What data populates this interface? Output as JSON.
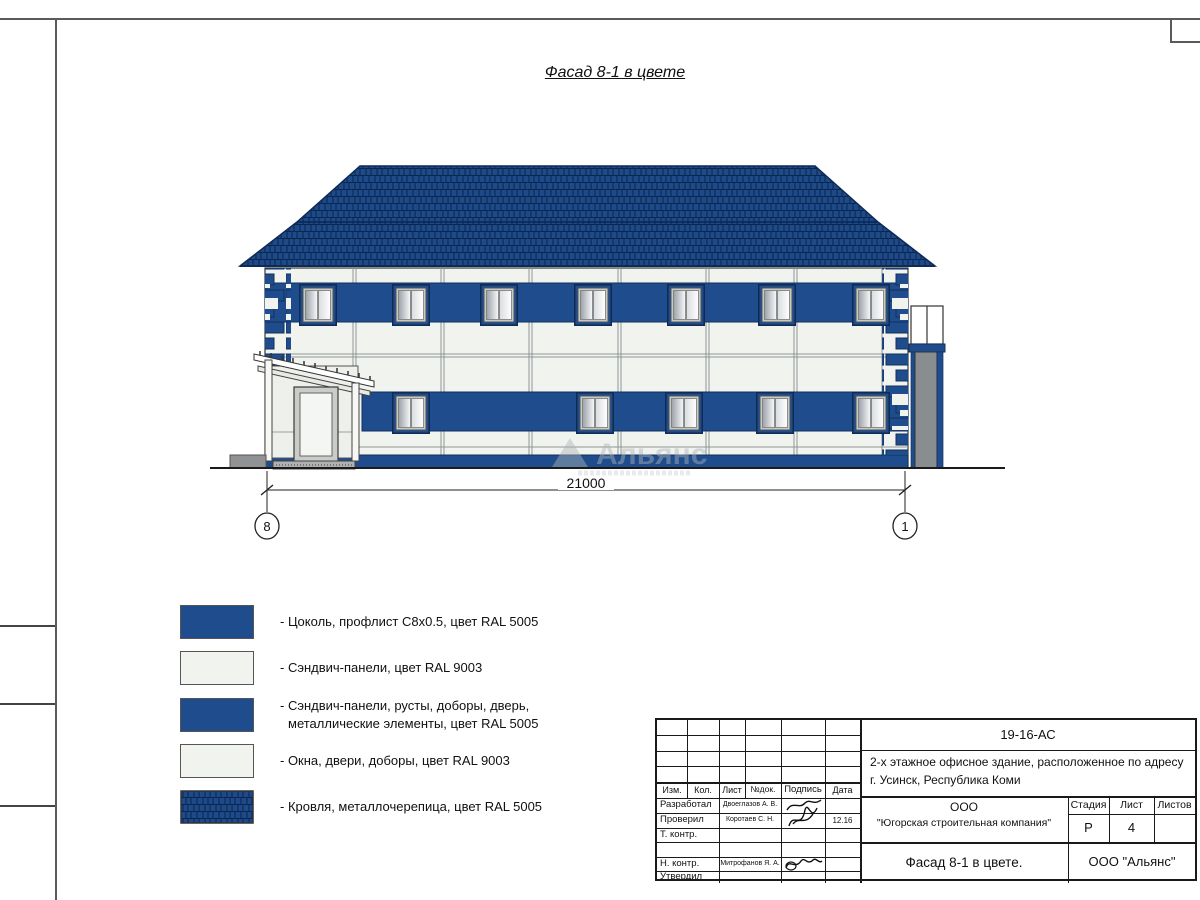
{
  "drawing_title": "Фасад 8-1 в цвете",
  "facade": {
    "dimension": "21000",
    "axis_left": "8",
    "axis_right": "1",
    "watermark": "Альянс"
  },
  "legend": {
    "items": [
      {
        "swatch": "solid-blue",
        "lines": [
          "- Цоколь, профлист С8х0.5, цвет RAL 5005"
        ]
      },
      {
        "swatch": "solid-white",
        "lines": [
          "- Сэндвич-панели, цвет RAL 9003"
        ]
      },
      {
        "swatch": "solid-blue",
        "lines": [
          "- Сэндвич-панели, русты, доборы, дверь,",
          "металлические элементы, цвет RAL 5005"
        ]
      },
      {
        "swatch": "solid-white",
        "lines": [
          "- Окна, двери, доборы, цвет RAL 9003"
        ]
      },
      {
        "swatch": "roof-tiles",
        "lines": [
          "- Кровля, металлочерепица, цвет RAL 5005"
        ]
      }
    ]
  },
  "title_block": {
    "doc_number": "19-16-АС",
    "description_line1": "2-х этажное офисное здание, расположенное по адресу",
    "description_line2": "г. Усинск, Республика Коми",
    "company_line1": "ООО",
    "company_line2": "\"Югорская строительная компания\"",
    "sheet_title": "Фасад 8-1 в цвете.",
    "org": "ООО \"Альянс\"",
    "stage_label": "Стадия",
    "sheet_label": "Лист",
    "sheets_label": "Листов",
    "stage_value": "Р",
    "sheet_value": "4",
    "sheets_value": "",
    "cols": [
      "Изм.",
      "Кол.",
      "Лист",
      "№док.",
      "Подпись",
      "Дата"
    ],
    "rows": [
      {
        "role": "Разработал",
        "name": "Двоеглазов А. В.",
        "date": ""
      },
      {
        "role": "Проверил",
        "name": "Коротаев С. Н.",
        "date": "12.16"
      },
      {
        "role": "Т. контр.",
        "name": "",
        "date": ""
      },
      {
        "role": "",
        "name": "",
        "date": ""
      },
      {
        "role": "Н. контр.",
        "name": "Митрофанов Я. А.",
        "date": ""
      },
      {
        "role": "Утвердил",
        "name": "",
        "date": ""
      }
    ]
  },
  "colors": {
    "ral5005_blue": "#1e4c8c",
    "ral9003_white": "#f1f3ef",
    "roof_blue": "#1d4a88"
  }
}
